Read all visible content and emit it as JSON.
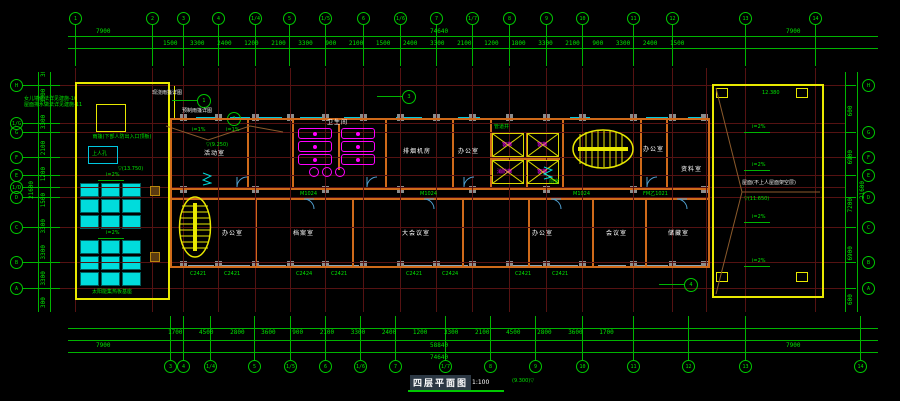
{
  "colors": {
    "green": "#00e400",
    "yellow": "#e8e800",
    "cyan": "#00dcdc",
    "magenta": "#ff00ff",
    "wall_orange": "#cf6a1a",
    "grid_red": "#551212",
    "window_blue": "#87a5b5",
    "column_gray": "#8c8c8c"
  },
  "title": {
    "name": "四层平面图",
    "scale": "1:100",
    "level_note": "(9.300)"
  },
  "grid_bubbles": {
    "top": [
      "1",
      "2",
      "3",
      "4",
      "1/4",
      "5",
      "1/5",
      "6",
      "1/6",
      "7",
      "1/7",
      "8",
      "9",
      "10",
      "11",
      "12",
      "13",
      "14"
    ],
    "bottom": [
      "3",
      "4",
      "1/4",
      "5",
      "1/5",
      "6",
      "1/6",
      "7",
      "1/7",
      "8",
      "9",
      "10",
      "11",
      "12",
      "13",
      "14"
    ],
    "left": [
      "H",
      "1/G",
      "G",
      "F",
      "E",
      "1/D",
      "D",
      "C",
      "B",
      "A"
    ],
    "right": [
      "H",
      "G",
      "F",
      "E",
      "D",
      "C",
      "B",
      "A"
    ]
  },
  "dimensions": {
    "top_total_left": "7900",
    "top_total_mid": "74640",
    "top_total_right": "7900",
    "top_segments": "1500 3300 2400 1200 2100 3300 900 2100 1500 2400 3300 2100 1200 1800 3300 2100 900 3300 2400 1500",
    "bottom_segments": "1700 4500 2800 3600 900 2100 3300 2400 1200 3300 2100 4500 2800 3600 1700",
    "bottom_total_left": "7900",
    "bottom_total_mid": "58840",
    "bottom_total_right": "7900",
    "bottom_total": "74640",
    "left_segments": "300 3300 3300 3300 1500 1200 2100 3300 3300 300",
    "left_total": "21600",
    "right_segments": "600 6900 7200 6900 600",
    "right_total": "21600"
  },
  "left_roof": {
    "canopy_note": "雨篷(下部人防出入口顶板)",
    "hatch": "上人孔",
    "slope": "i=2%",
    "level": "(13.750)",
    "panel_note": "太阳能集热板基座"
  },
  "right_roof": {
    "label": "屋面(不上人屋面架空层)",
    "slope": "i=2%",
    "level_top": "12.380",
    "level_mid": "(11.650)"
  },
  "canopy": {
    "note1": "现浇雨篷详图",
    "note2": "预制雨篷详图",
    "slope": "i=1%",
    "callout1": "1",
    "callout2": "2",
    "callout3": "3",
    "callout4": "4"
  },
  "rooms": {
    "t1": "活动室",
    "t2": "卫生间",
    "t3": "排烟机房",
    "t4": "办公室",
    "t6": "办公室",
    "t7": "资料室",
    "b1": "办公室",
    "b2": "档案室",
    "b3": "大会议室",
    "b4": "办公室",
    "b5": "会议室",
    "b6": "储藏室"
  },
  "fixtures": {
    "elevator1": "客梯",
    "elevator2": "客梯",
    "elevator3": "消防梯",
    "elevator4": "客梯",
    "shaft_note": "管道井",
    "front_room": "前室"
  },
  "windows": {
    "w1": "C2421",
    "w2": "C2421",
    "w3": "C2424",
    "w4": "C2421",
    "w5": "C2421",
    "w6": "C2424",
    "w7": "C2421",
    "w8": "C2421"
  },
  "doors": {
    "d1": "M1024",
    "d2": "M1024",
    "d3": "M1024",
    "d4": "FM乙1021"
  },
  "notes": {
    "left_line1": "女儿墙做法详见建施-10",
    "left_line2": "屋面排水做法详见建施-11"
  },
  "levels": {
    "building": "(9.250)"
  }
}
